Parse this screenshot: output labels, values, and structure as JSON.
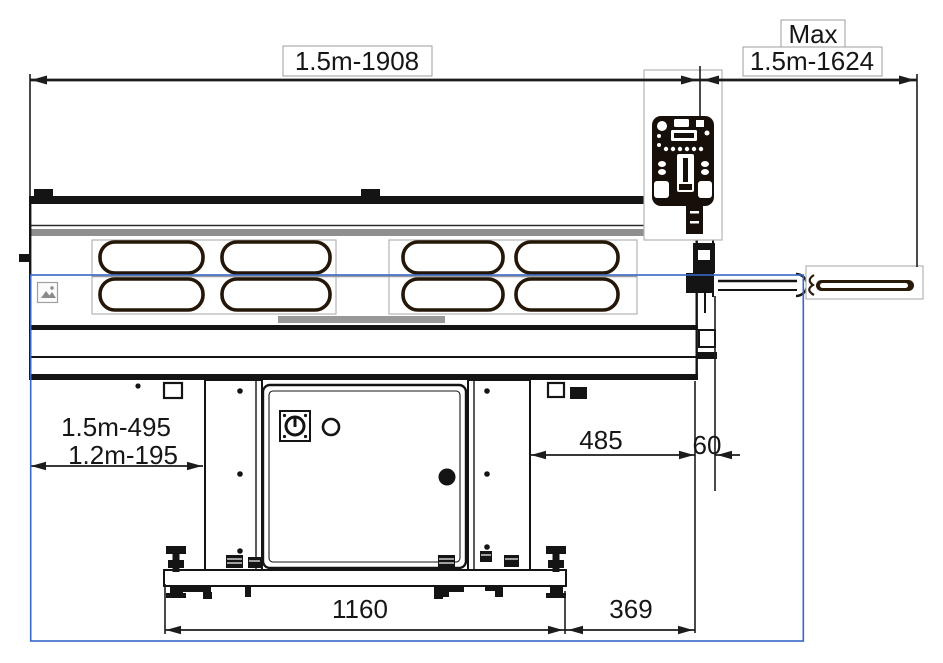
{
  "canvas": {
    "width": 943,
    "height": 663,
    "background": "#ffffff"
  },
  "drawing": {
    "kind": "technical dimensional drawing - machine side view",
    "colors": {
      "ink": "#1c1c1c",
      "heavy_ink": "#241708",
      "gray_band": "#8f8f8f",
      "box_border": "#b3b3b3",
      "selection_blue": "#3867c4"
    },
    "dimensions": {
      "top_span": "1.5m-1908",
      "top_right_prefix": "Max",
      "top_right_span": "1.5m-1624",
      "left_offset_model_15": "1.5m-495",
      "left_offset_model_12": "1.2m-195",
      "right_offset": "485",
      "right_gap": "60",
      "base_width": "1160",
      "base_right_offset": "369"
    },
    "icons": {
      "selection_marker": "image-placeholder-icon"
    }
  }
}
